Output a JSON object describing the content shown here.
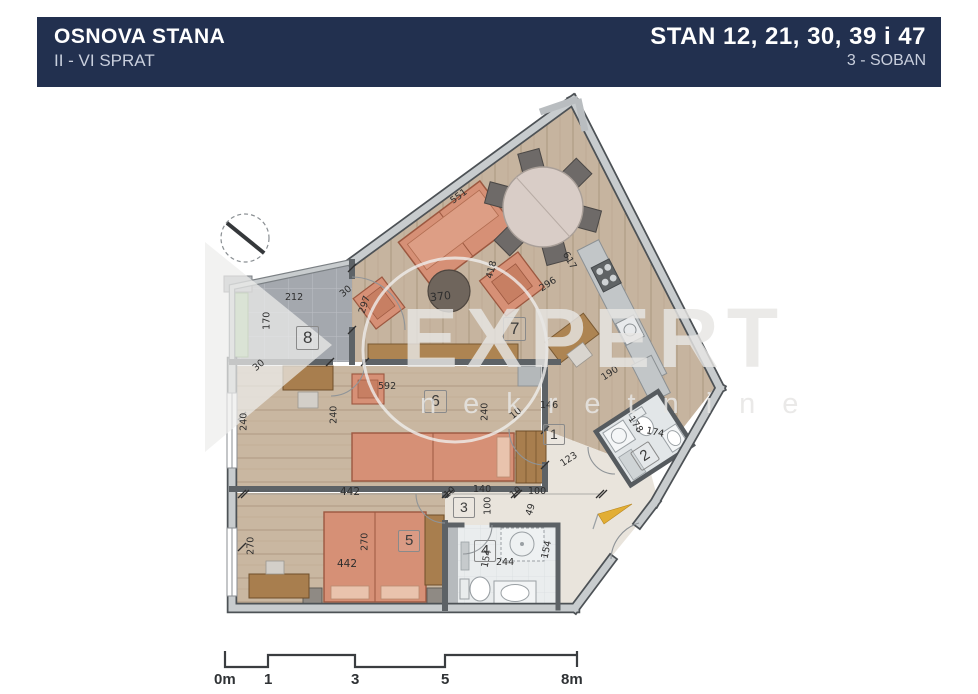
{
  "header": {
    "left_title": "OSNOVA STANA",
    "left_subtitle": "II - VI SPRAT",
    "right_title": "STAN 12, 21, 30, 39 i 47",
    "right_subtitle": "3 - SOBAN"
  },
  "watermark": {
    "brand": "EXPERT",
    "brand_sub": "nekretnine"
  },
  "rooms": {
    "r1": "1",
    "r2": "2",
    "r3": "3",
    "r4": "4",
    "r5": "5",
    "r6": "6",
    "r7": "7",
    "r8": "8"
  },
  "dims": {
    "living_top_wall": "551",
    "terrace_width": "212",
    "terrace_depth": "170",
    "wall_30_terrace": "30",
    "wall_30_room6": "30",
    "living_left_height": "297",
    "living_width": "370",
    "armchair_zone": "418",
    "living_diag": "296",
    "living_right_wall": "617",
    "kitchen_run": "190",
    "room6_width": "592",
    "room6_depth_left": "240",
    "room6_depth_mid": "240",
    "room6_depth_right": "240",
    "hall_seg_10": "10",
    "hall_width": "146",
    "hall_diag": "123",
    "bath2_side_a": "178",
    "bath2_side_b": "174",
    "entry_seg_100": "100",
    "entry_seg_49": "49",
    "corridor_10a": "10",
    "corridor_140": "140",
    "corridor_10b": "10",
    "corridor_depth": "100",
    "bed6_length": "442",
    "bed5_length": "442",
    "room5_depth_left": "270",
    "room5_depth_mid": "270",
    "bath4_left": "154",
    "bath4_width": "244",
    "bath4_right": "154"
  },
  "scale": {
    "l0": "0m",
    "l1": "1",
    "l2": "3",
    "l3": "5",
    "l4": "8m"
  },
  "colors": {
    "header_bg": "#22304f",
    "wood": "#c6b49f",
    "terrace": "#a6a9af",
    "sofa": "#d69076",
    "wood_furniture": "#a87e4e",
    "flag": "#e2ae35"
  }
}
